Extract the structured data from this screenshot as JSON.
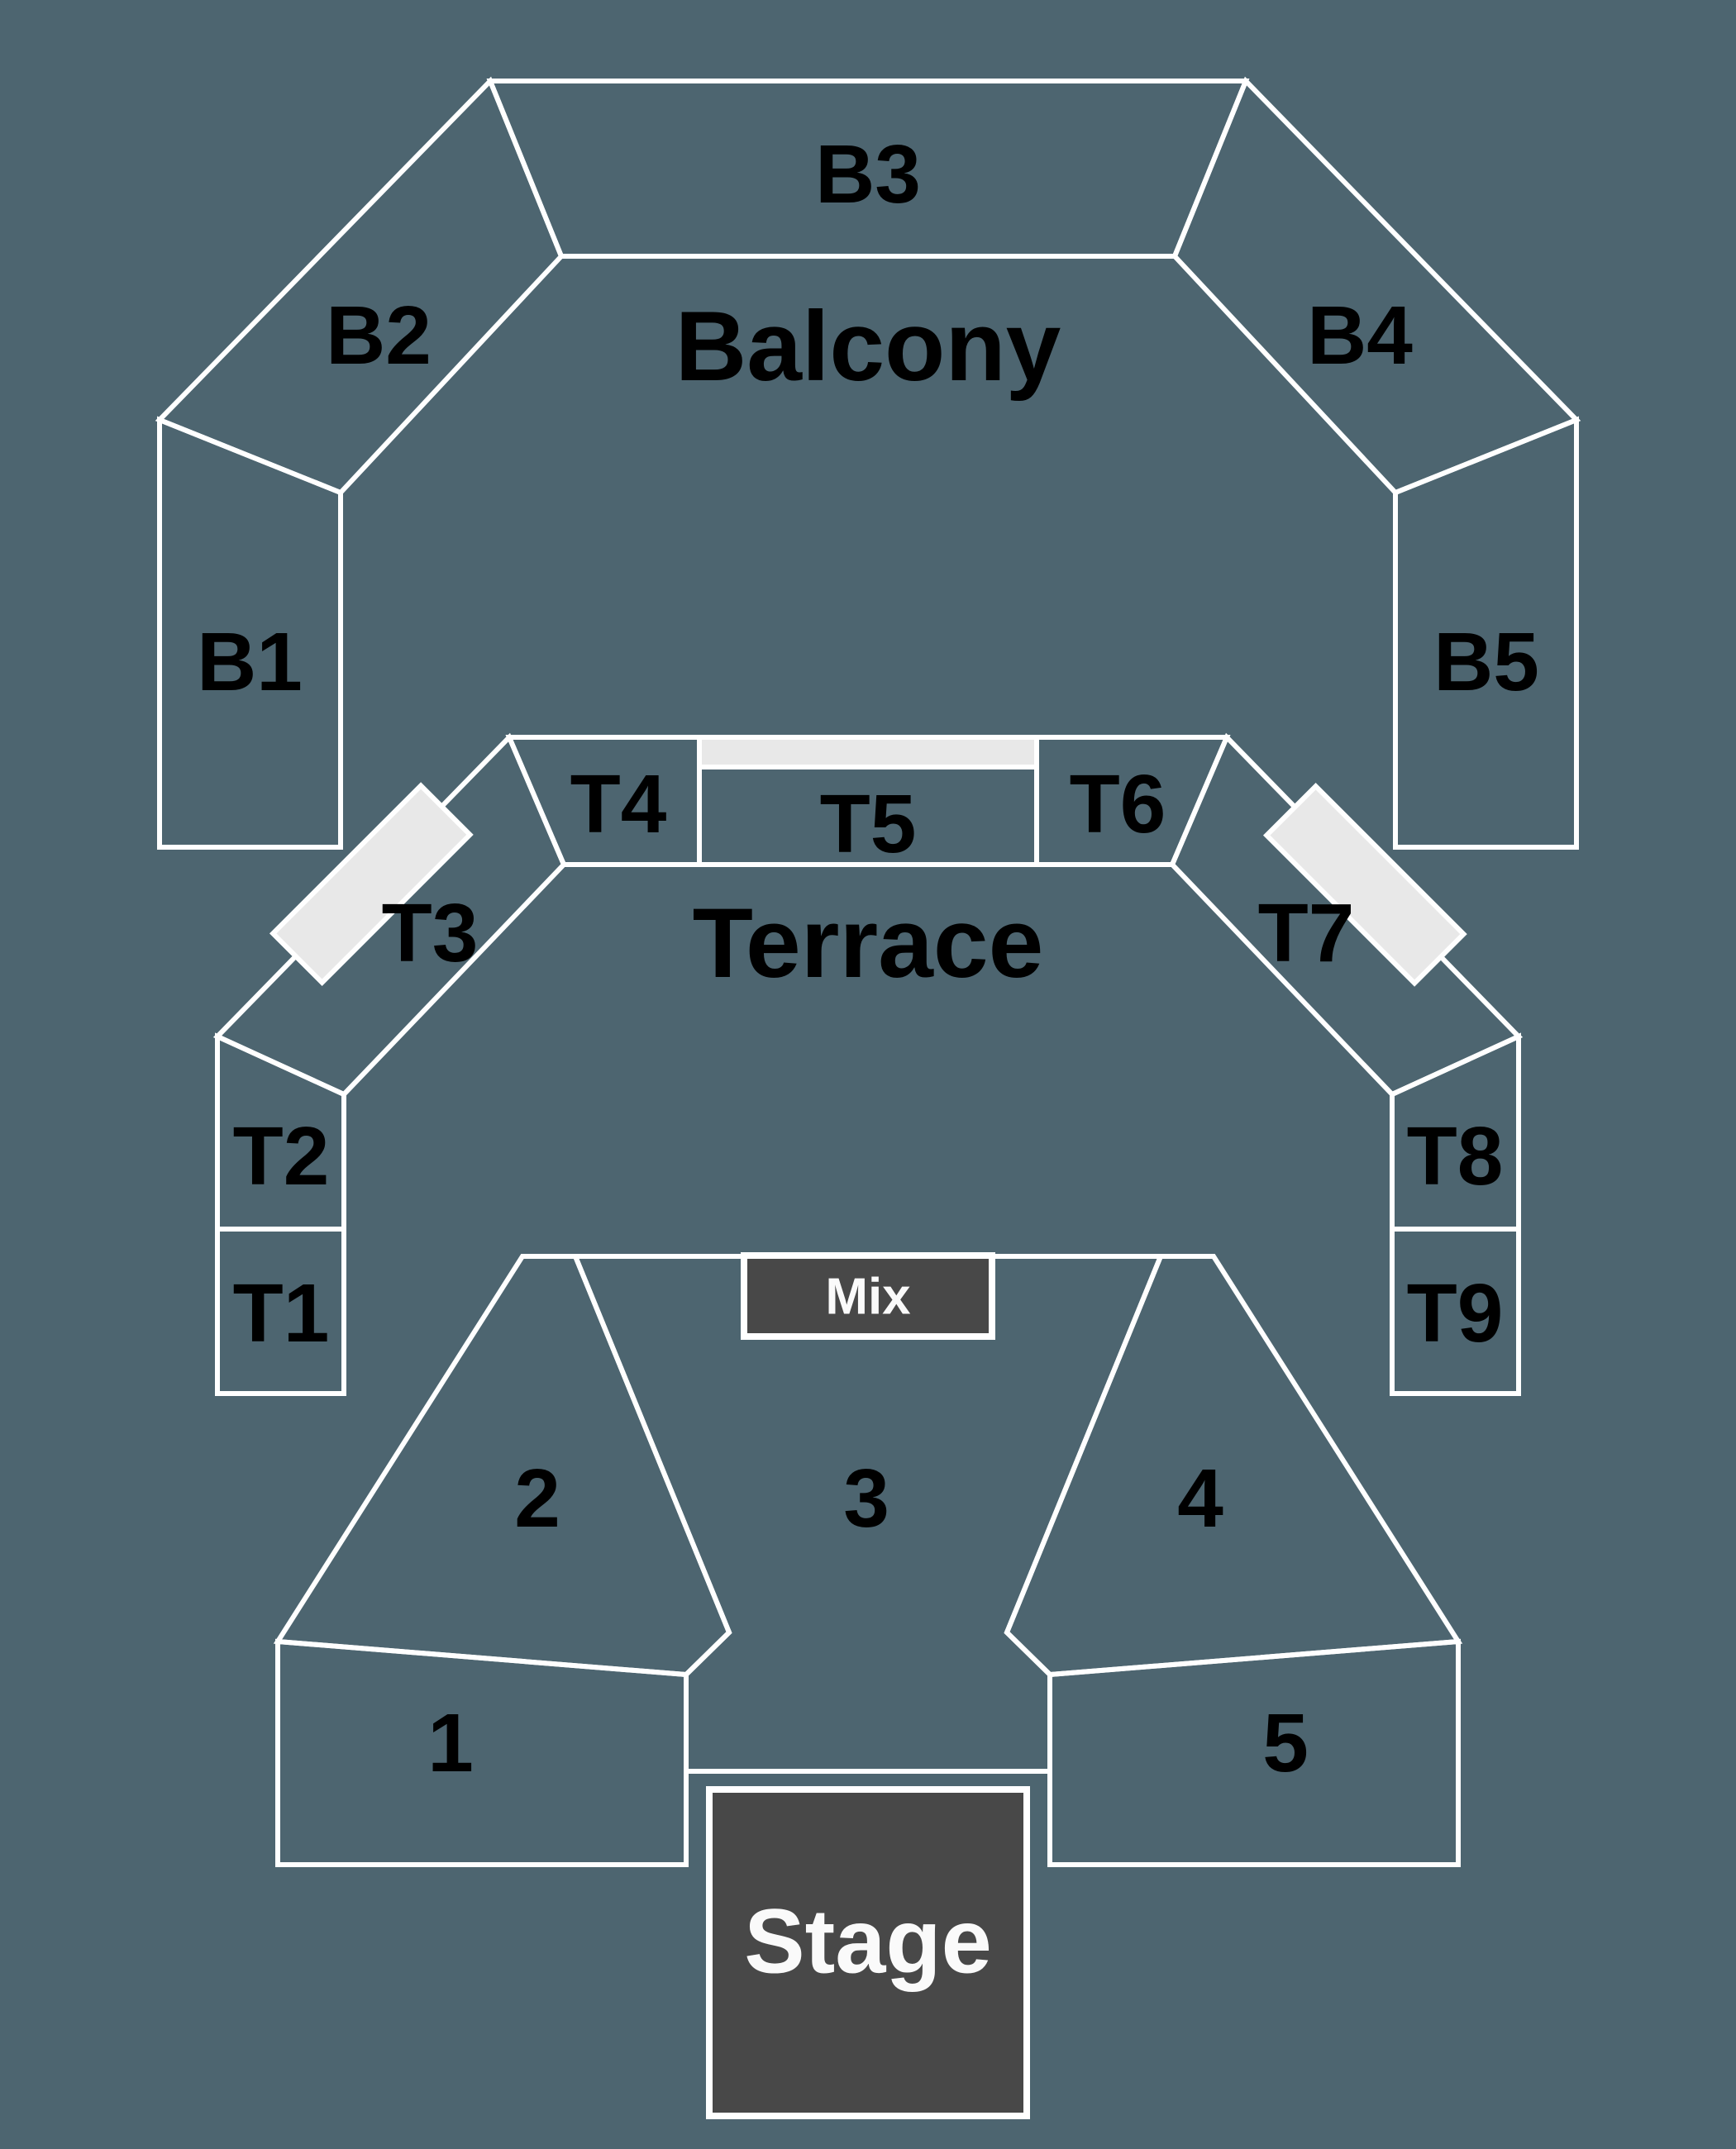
{
  "colors": {
    "background": "#4d6570",
    "outline": "#ffffff",
    "label-text": "#000000",
    "inverse-text": "#fafafa",
    "booth-fill": "#484848",
    "aisle-fill": "#e8e8e8"
  },
  "map": {
    "balcony": {
      "label": "Balcony",
      "sections": [
        {
          "label": "B1"
        },
        {
          "label": "B2"
        },
        {
          "label": "B3"
        },
        {
          "label": "B4"
        },
        {
          "label": "B5"
        }
      ]
    },
    "terrace": {
      "label": "Terrace",
      "sections": [
        {
          "label": "T1"
        },
        {
          "label": "T2"
        },
        {
          "label": "T3"
        },
        {
          "label": "T4"
        },
        {
          "label": "T5"
        },
        {
          "label": "T6"
        },
        {
          "label": "T7"
        },
        {
          "label": "T8"
        },
        {
          "label": "T9"
        }
      ]
    },
    "floor": {
      "sections": [
        {
          "label": "1"
        },
        {
          "label": "2"
        },
        {
          "label": "3"
        },
        {
          "label": "4"
        },
        {
          "label": "5"
        }
      ]
    },
    "mix_booth": {
      "label": "Mix"
    },
    "stage": {
      "label": "Stage"
    }
  }
}
